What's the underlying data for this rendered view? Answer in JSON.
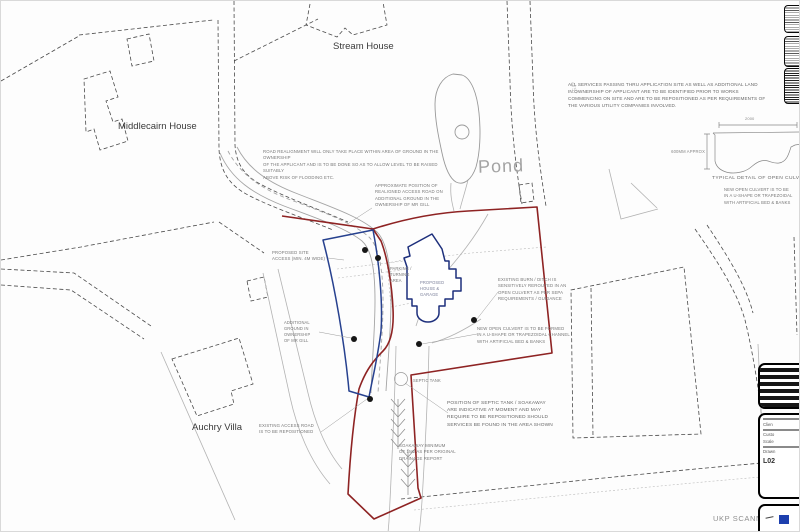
{
  "labels": {
    "stream_house": "Stream House",
    "middlecairn_house": "Middlecairn House",
    "auchry_villa": "Auchry Villa",
    "pond": "Pond",
    "faint_number": "4757",
    "ukp_scanned": "UKP SCANNED"
  },
  "notes": {
    "road_realignment": "ROAD REALIGNMENT WILL ONLY TAKE PLACE WITHIN AREA OF GROUND IN THE OWNERSHIP\nOF THE APPLICANT AND IS TO BE DONE SO AS TO ALLOW LEVEL TO BE RAISED SUITABLY\nABOVE RISK OF FLOODING ETC.",
    "services": "ALL SERVICES PASSING THRU APPLICATION SITE AS WELL AS ADDITIONAL LAND\nIN OWNERSHIP OF APPLICANT ARE TO BE IDENTIFIED PRIOR TO WORKS\nCOMMENCING ON SITE AND ARE TO BE REPOSITIONED AS PER REQUIREMENTS OF\nTHE VARIOUS UTILITY COMPANIES INVOLVED.",
    "realigned_access": "APPROXIMATE POSITION OF\nREALIGNED ACCESS ROAD ON\nADDITIONAL GROUND IN THE\nOWNERSHIP OF MR GILL",
    "proposed_access": "PROPOSED SITE\nACCESS (MIN. 4M WIDE)",
    "parking": "PARKING /\nTURNING\nAREA",
    "proposed_house": "PROPOSED\nHOUSE &\nGARAGE",
    "additional_ground": "ADDITIONAL\nGROUND IN\nOWNERSHIP\nOF MR GILL",
    "existing_access": "EXISTING ACCESS ROAD\nIS TO BE REPOSITIONED",
    "existing_burn": "EXISTING BURN / DITCH IS\nSENSITIVELY REROUTED IN AN\nOPEN CULVERT AS PER SEPA\nREQUIREMENTS / GUIDANCE",
    "new_culvert": "NEW OPEN CULVERT IS TO BE FORMED\nIN A U-SHAPE OR TRAPEZOIDAL CHANNEL\nWITH ARTIFICIAL BED & BANKS",
    "septic_tank": "SEPTIC TANK",
    "septic_position": "POSITION OF SEPTIC TANK / SOAKAWAY\nARE INDICATIVE AT MOMENT AND MAY\nREQUIRE TO BE REPOSITIONED SHOULD\nSERVICES BE FOUND IN THE AREA SHOWN",
    "soakaway": "SOAKAWAY MINIMUM\nOF 1M2 AS PER ORIGINAL\nDRAINAGE REPORT"
  },
  "culvert_detail": {
    "width_dim": "2000",
    "depth_dim": "600MM APPROX",
    "caption": "TYPICAL DETAIL OF OPEN CULVERT",
    "note": "NEW OPEN CULVERT IS TO BE\nIN A U-SHAPE OR TRAPEZOIDAL\nWITH ARTIFICIAL BED & BANKS"
  },
  "titleblock": {
    "lines": [
      "Clien",
      "Custo",
      "Scale",
      "Drawn"
    ],
    "drawing_number": "L02"
  },
  "colors": {
    "site_boundary": "#8e2323",
    "additional_land": "#27418f",
    "proposed_building": "#1d2f7c",
    "logo_blue": "#1d3fae"
  }
}
